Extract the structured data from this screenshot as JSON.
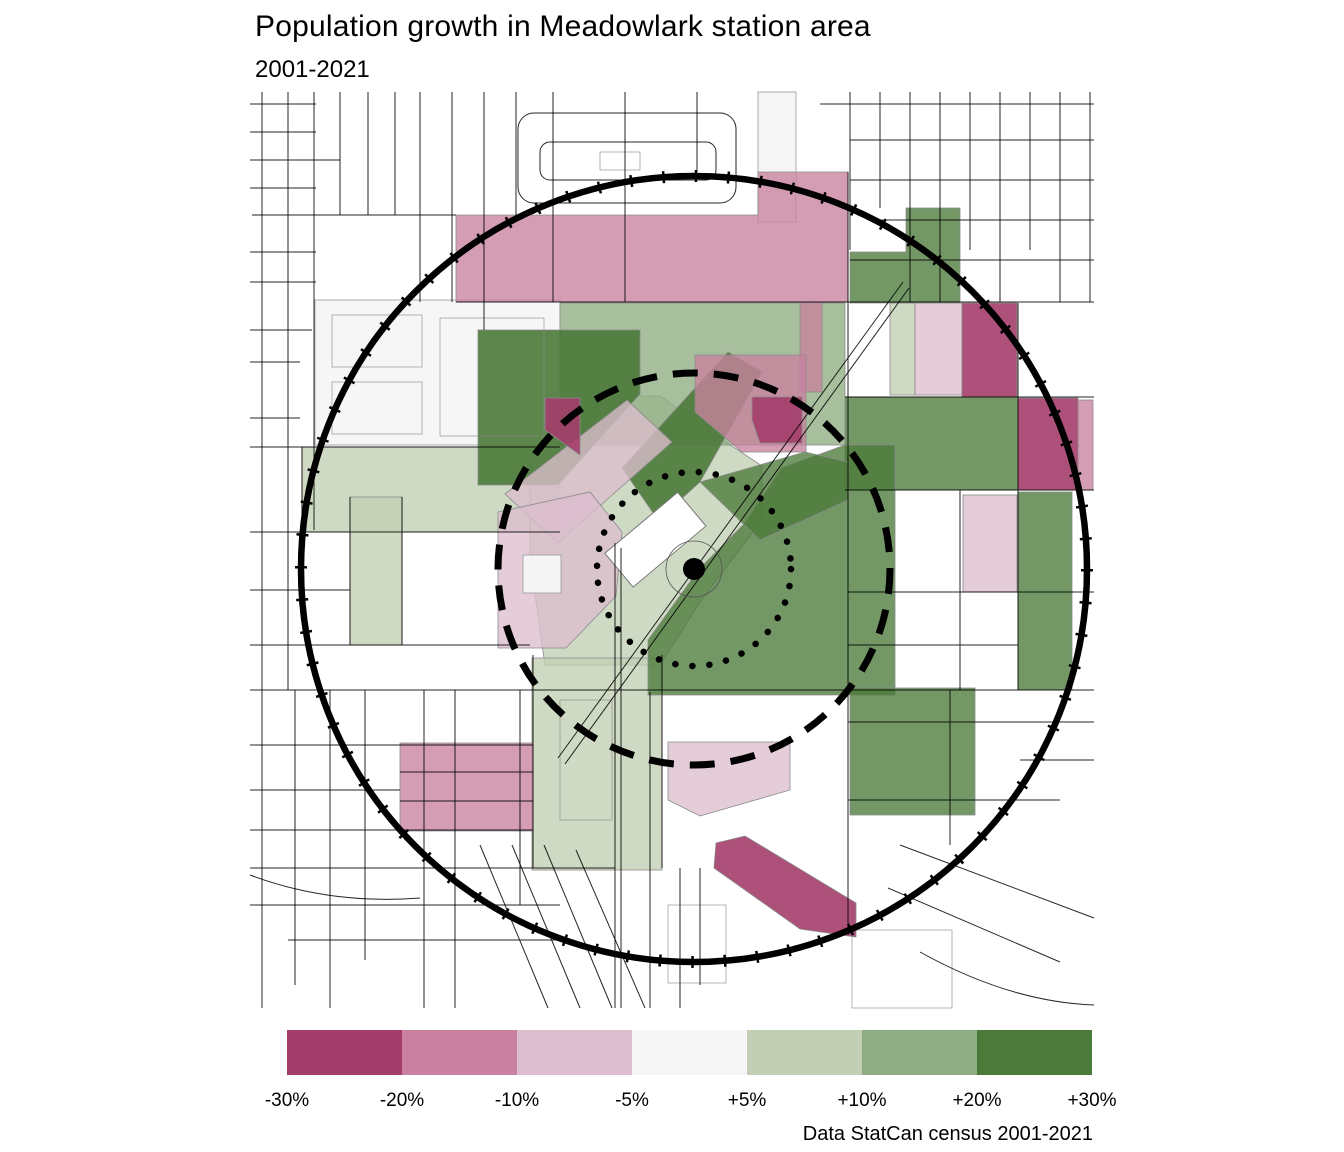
{
  "title": "Population growth in Meadowlark station area",
  "subtitle": "2001-2021",
  "caption": "Data StatCan census 2001-2021",
  "legend": {
    "labels": [
      "-30%",
      "-20%",
      "-10%",
      "-5%",
      "+5%",
      "+10%",
      "+20%",
      "+30%"
    ],
    "colors": [
      "#a43d6b",
      "#c9819f",
      "#ddbece",
      "#f6f6f6",
      "#c2cfb4",
      "#8ead82",
      "#4b7a3a"
    ]
  },
  "colors": {
    "dark_magenta": "#a43d6b",
    "mid_pink": "#c9819f",
    "light_pink": "#ddbece",
    "off_white": "#f6f6f6",
    "light_green": "#c2cfb4",
    "mid_green": "#8ead82",
    "dark_green": "#4b7a3a",
    "ring": "#000000"
  },
  "map": {
    "type": "choropleth",
    "center_marker": "station-location",
    "rings": [
      "outer-solid-circle",
      "middle-dashed-circle",
      "inner-dotted-circle"
    ]
  }
}
